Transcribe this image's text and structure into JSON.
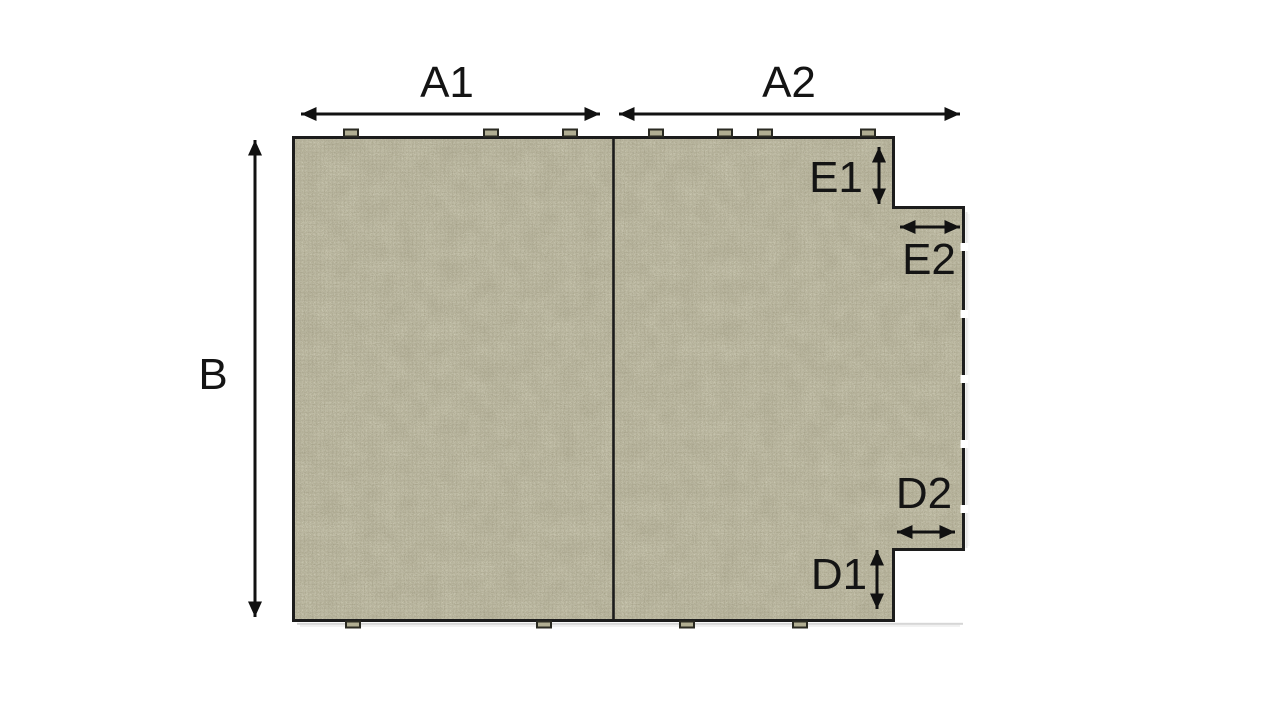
{
  "diagram": {
    "type": "dimension-diagram",
    "subject": "textured mat panel with a stepped tab on the right edge, split in two sections by a vertical seam",
    "colors": {
      "background": "#ffffff",
      "mat_fill": "#b1ae92",
      "outline": "#1c1c1c",
      "dimension_color": "#111111",
      "label_color": "#141414"
    },
    "dimensions": [
      {
        "label": "A1",
        "orientation": "horizontal",
        "position": "top-left-section"
      },
      {
        "label": "A2",
        "orientation": "horizontal",
        "position": "top-right-section"
      },
      {
        "label": "B",
        "orientation": "vertical",
        "position": "left-full-height"
      },
      {
        "label": "E1",
        "orientation": "vertical",
        "position": "upper-right-step"
      },
      {
        "label": "E2",
        "orientation": "horizontal",
        "position": "upper-right-tab"
      },
      {
        "label": "D2",
        "orientation": "horizontal",
        "position": "lower-right-tab"
      },
      {
        "label": "D1",
        "orientation": "vertical",
        "position": "lower-right-step"
      }
    ]
  }
}
